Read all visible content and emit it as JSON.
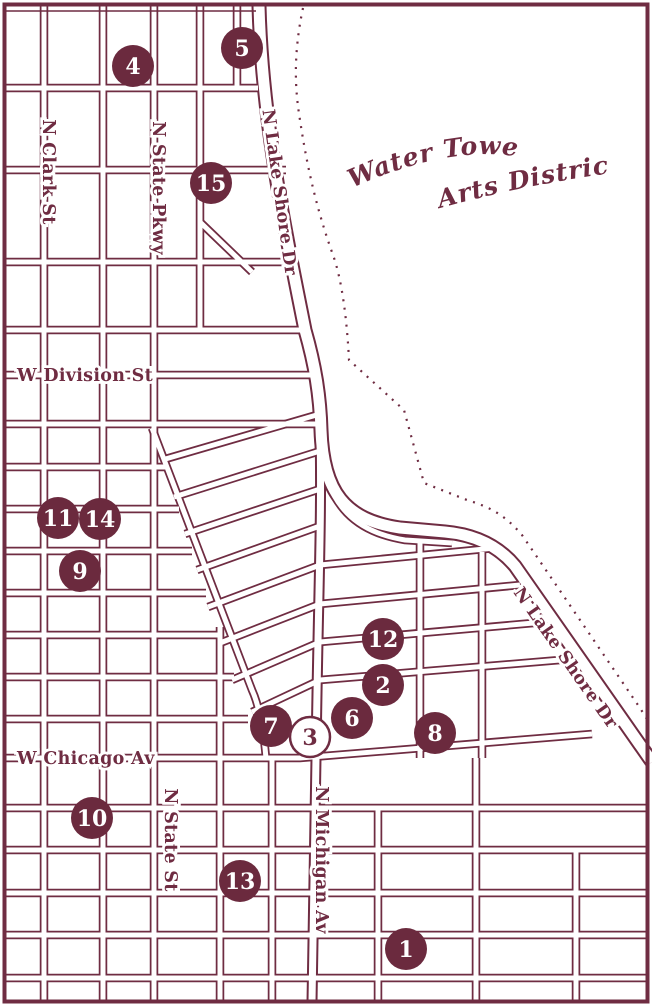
{
  "title": {
    "line1": "Water Tower",
    "line2": "Arts District"
  },
  "map": {
    "colors": {
      "line": "#6f2c42",
      "marker_fill": "#6b2a3e",
      "marker_open_fill": "#ffffff",
      "background": "#ffffff"
    },
    "street_labels": [
      {
        "id": "n-clark-st",
        "text": "N Clark St",
        "x": 43,
        "y": 172,
        "rotate": 90,
        "anchor": "middle"
      },
      {
        "id": "n-state-pkwy",
        "text": "N State Pkwy",
        "x": 153,
        "y": 188,
        "rotate": 90,
        "anchor": "middle"
      },
      {
        "id": "n-lake-shore-dr-upper",
        "text": "N Lake Shore Dr",
        "x": 274,
        "y": 193,
        "rotate": 82,
        "anchor": "middle"
      },
      {
        "id": "w-division-st",
        "text": "W Division St",
        "x": 17,
        "y": 381,
        "rotate": 0,
        "anchor": "start"
      },
      {
        "id": "w-chicago-av",
        "text": "W Chicago Av",
        "x": 17,
        "y": 764,
        "rotate": 0,
        "anchor": "start"
      },
      {
        "id": "n-state-st",
        "text": "N State St",
        "x": 165,
        "y": 840,
        "rotate": 90,
        "anchor": "middle"
      },
      {
        "id": "n-michigan-av",
        "text": "N Michigan Av",
        "x": 316,
        "y": 860,
        "rotate": 90,
        "anchor": "middle"
      },
      {
        "id": "n-lake-shore-dr-lower",
        "text": "N Lake Shore Dr",
        "x": 561,
        "y": 661,
        "rotate": 55,
        "anchor": "middle"
      }
    ],
    "markers": [
      {
        "n": "4",
        "x": 133,
        "y": 66,
        "variant": "filled"
      },
      {
        "n": "5",
        "x": 242,
        "y": 48,
        "variant": "filled"
      },
      {
        "n": "15",
        "x": 211,
        "y": 183,
        "variant": "filled"
      },
      {
        "n": "11",
        "x": 58,
        "y": 518,
        "variant": "filled"
      },
      {
        "n": "14",
        "x": 100,
        "y": 519,
        "variant": "filled"
      },
      {
        "n": "9",
        "x": 80,
        "y": 571,
        "variant": "filled"
      },
      {
        "n": "12",
        "x": 383,
        "y": 639,
        "variant": "filled"
      },
      {
        "n": "2",
        "x": 383,
        "y": 685,
        "variant": "filled"
      },
      {
        "n": "6",
        "x": 352,
        "y": 718,
        "variant": "filled"
      },
      {
        "n": "7",
        "x": 271,
        "y": 726,
        "variant": "filled"
      },
      {
        "n": "8",
        "x": 435,
        "y": 733,
        "variant": "filled"
      },
      {
        "n": "10",
        "x": 92,
        "y": 818,
        "variant": "filled"
      },
      {
        "n": "13",
        "x": 240,
        "y": 881,
        "variant": "filled"
      },
      {
        "n": "1",
        "x": 406,
        "y": 949,
        "variant": "filled"
      },
      {
        "n": "3",
        "x": 310,
        "y": 737,
        "variant": "open"
      }
    ]
  }
}
